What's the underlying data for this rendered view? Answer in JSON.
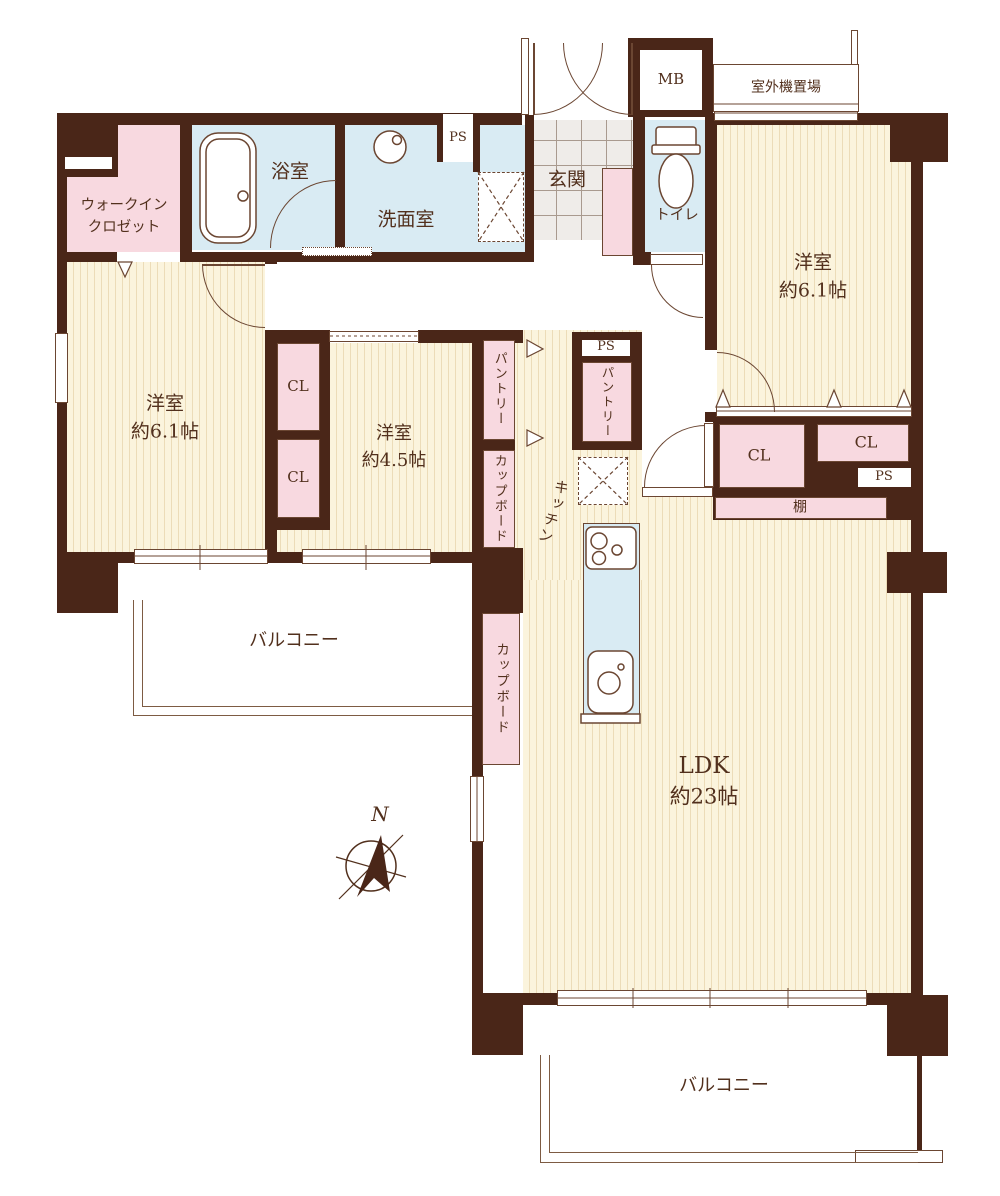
{
  "colors": {
    "wall": "#4a2618",
    "outline": "#6b4632",
    "text": "#52301d",
    "pink": "#f8d9e0",
    "blue": "#d9ebf3",
    "floor": "#fbf4dd",
    "floor_stripe": "#ecdcb8",
    "tile": "#efece9",
    "bg": "#ffffff"
  },
  "rooms": {
    "walk_in_closet": {
      "line1": "ウォークイン",
      "line2": "クロゼット"
    },
    "bath": {
      "label": "浴室"
    },
    "washroom": {
      "label": "洗面室"
    },
    "entrance": {
      "label": "玄関"
    },
    "toilet": {
      "label": "トイレ"
    },
    "bedroom_right": {
      "name": "洋室",
      "size": "約6.1帖"
    },
    "bedroom_left": {
      "name": "洋室",
      "size": "約6.1帖"
    },
    "bedroom_small": {
      "name": "洋室",
      "size": "約4.5帖"
    },
    "kitchen": {
      "label": "キッチン"
    },
    "ldk": {
      "name": "LDK",
      "size": "約23帖"
    },
    "balcony_left": {
      "label": "バルコニー"
    },
    "balcony_bottom": {
      "label": "バルコニー"
    }
  },
  "storage": {
    "cl_left_upper": "CL",
    "cl_left_lower": "CL",
    "cl_right_a": "CL",
    "cl_right_b": "CL",
    "pantry_left": "パントリー",
    "pantry_center": "パントリー",
    "cupboard_upper": "カップボード",
    "cupboard_lower": "カップボード",
    "shelf": "棚"
  },
  "utilities": {
    "mb": "MB",
    "outdoor_unit": "室外機置場",
    "ps_washroom": "PS",
    "ps_kitchen": "PS",
    "ps_ldk": "PS"
  },
  "compass": {
    "north_label": "N"
  }
}
